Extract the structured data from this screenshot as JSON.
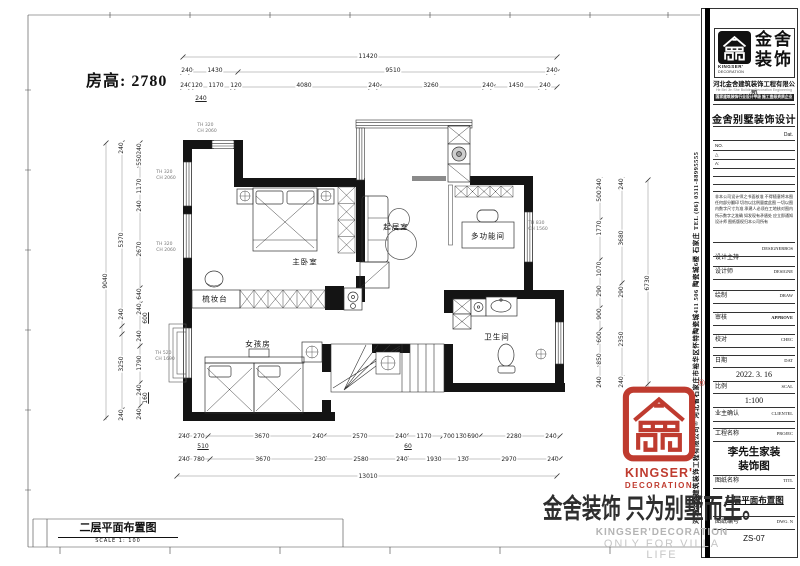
{
  "header": {
    "room_height": "房高: 2780"
  },
  "sheet": {
    "plan_label": "二层平面布置图",
    "plan_scale": "SCALE 1: 100"
  },
  "watermark": {
    "cn": "金舍装饰 只为别墅而生。",
    "en1": "KINGSER'DECORATION",
    "en2": "ONLY FOR VILLA LIFE"
  },
  "stamp": {
    "en1": "KINGSER'",
    "en2": "DECORATION",
    "reg": "®"
  },
  "colors": {
    "stamp_red": "#bf3b2f",
    "wall_black": "#141414",
    "watermark_gray": "#b4b4b4"
  },
  "tb": {
    "logo_cn1": "金舍",
    "logo_cn2": "装饰",
    "logo_en1": "KINGSER'",
    "logo_en2": "DECORATION",
    "company": "河北金舍建筑装饰工程有限公司",
    "company_en": "He Bei Jin She Building Decoration Engineering Co., L",
    "cert": "国家建筑装饰行业设计甲级 施工壹级资质企业",
    "product_title": "金舍别墅装饰设计",
    "dat_label": "Dat.",
    "no_label": "NO.",
    "tri": "△",
    "a_label": "A:",
    "note": "非本公司设计师之书面核准 不得随意将本图任何部分翻印 切勿以比例量度此图 一切以图内数字尺寸为准 承建人必须在工地核对图内所示数字之准确 如发现有矛盾处 应立即通知设计师 图纸版权归本公司所有",
    "vertical_text": "河北金舍建筑装饰工程有限公司® 河北省石家庄市裕华区怀特陶瓷城411 506 陶瓷城6楼 石家庄 TEL (86) 0311-88995555",
    "fields": [
      {
        "cn": "设计主持",
        "en": "DESIGNERBOS",
        "val": ""
      },
      {
        "cn": "设计师",
        "en": "DESIGNE",
        "val": ""
      },
      {
        "cn": "绘制",
        "en": "DRAW",
        "val": ""
      },
      {
        "cn": "审核",
        "en": "APPROVE",
        "val": ""
      },
      {
        "cn": "校对",
        "en": "CHEC",
        "val": ""
      },
      {
        "cn": "日期",
        "en": "DAT",
        "val": "2022. 3. 16"
      },
      {
        "cn": "比例",
        "en": "SCAL",
        "val": "1:100"
      },
      {
        "cn": "业主确认",
        "en": "CLIENTEL",
        "val": ""
      },
      {
        "cn": "工程名称",
        "en": "PROJEC",
        "val": "李先生家装\n装饰图"
      },
      {
        "cn": "图纸名称",
        "en": "TITL",
        "val": "二层平面布置图"
      },
      {
        "cn": "图纸编号",
        "en": "DWG. N",
        "val": "ZS-07"
      }
    ]
  },
  "plan": {
    "rooms": [
      {
        "t": "主卧室",
        "x": 305,
        "y": 262
      },
      {
        "t": "起居室",
        "x": 396,
        "y": 227
      },
      {
        "t": "多功能间",
        "x": 488,
        "y": 236
      },
      {
        "t": "梳妆台",
        "x": 215,
        "y": 299
      },
      {
        "t": "女孩房",
        "x": 258,
        "y": 344
      },
      {
        "t": "卫生间",
        "x": 497,
        "y": 337
      }
    ],
    "window_labels": [
      {
        "t": "TH 320\nCH 2060",
        "x": 207,
        "y": 129
      },
      {
        "t": "TH 320\nCH 2060",
        "x": 166,
        "y": 176
      },
      {
        "t": "TH 320\nCH 2060",
        "x": 166,
        "y": 248
      },
      {
        "t": "TH 520\nCH 1690",
        "x": 165,
        "y": 357
      },
      {
        "t": "TH 830\nCH 1560",
        "x": 538,
        "y": 227
      }
    ],
    "dims": [
      {
        "t": "11420",
        "x": 368,
        "y": 57
      },
      {
        "t": "240",
        "x": 187,
        "y": 71
      },
      {
        "t": "1430",
        "x": 215,
        "y": 71
      },
      {
        "t": "9510",
        "x": 393,
        "y": 71
      },
      {
        "t": "240",
        "x": 552,
        "y": 71
      },
      {
        "t": "240",
        "x": 186,
        "y": 86
      },
      {
        "t": "120",
        "x": 197,
        "y": 86
      },
      {
        "t": "1170",
        "x": 216,
        "y": 86
      },
      {
        "t": "120",
        "x": 236,
        "y": 86
      },
      {
        "t": "4080",
        "x": 304,
        "y": 86
      },
      {
        "t": "240",
        "x": 374,
        "y": 86
      },
      {
        "t": "3260",
        "x": 431,
        "y": 86
      },
      {
        "t": "240",
        "x": 488,
        "y": 86
      },
      {
        "t": "1450",
        "x": 516,
        "y": 86
      },
      {
        "t": "240",
        "x": 545,
        "y": 86
      },
      {
        "t": "240",
        "x": 201,
        "y": 99,
        "u": true
      },
      {
        "t": "240",
        "x": 184,
        "y": 437
      },
      {
        "t": "270",
        "x": 199,
        "y": 437
      },
      {
        "t": "3670",
        "x": 262,
        "y": 437
      },
      {
        "t": "240",
        "x": 318,
        "y": 437
      },
      {
        "t": "2570",
        "x": 360,
        "y": 437
      },
      {
        "t": "240",
        "x": 401,
        "y": 437
      },
      {
        "t": "1170",
        "x": 424,
        "y": 437
      },
      {
        "t": "700",
        "x": 449,
        "y": 437
      },
      {
        "t": "130",
        "x": 461,
        "y": 437
      },
      {
        "t": "690",
        "x": 473,
        "y": 437
      },
      {
        "t": "2280",
        "x": 514,
        "y": 437
      },
      {
        "t": "240",
        "x": 551,
        "y": 437
      },
      {
        "t": "510",
        "x": 203,
        "y": 447,
        "u": true
      },
      {
        "t": "60",
        "x": 408,
        "y": 447,
        "u": true
      },
      {
        "t": "240",
        "x": 184,
        "y": 460
      },
      {
        "t": "780",
        "x": 199,
        "y": 460
      },
      {
        "t": "3670",
        "x": 263,
        "y": 460
      },
      {
        "t": "230",
        "x": 320,
        "y": 460
      },
      {
        "t": "2580",
        "x": 361,
        "y": 460
      },
      {
        "t": "240",
        "x": 402,
        "y": 460
      },
      {
        "t": "1930",
        "x": 434,
        "y": 460
      },
      {
        "t": "130",
        "x": 463,
        "y": 460
      },
      {
        "t": "2970",
        "x": 509,
        "y": 460
      },
      {
        "t": "240",
        "x": 553,
        "y": 460
      },
      {
        "t": "13010",
        "x": 368,
        "y": 477
      },
      {
        "t": "240",
        "x": 140,
        "y": 149,
        "r": 1
      },
      {
        "t": "550",
        "x": 140,
        "y": 160,
        "r": 1
      },
      {
        "t": "1170",
        "x": 140,
        "y": 186,
        "r": 1
      },
      {
        "t": "240",
        "x": 140,
        "y": 206,
        "r": 1
      },
      {
        "t": "2670",
        "x": 140,
        "y": 249,
        "r": 1
      },
      {
        "t": "640",
        "x": 140,
        "y": 294,
        "r": 1
      },
      {
        "t": "240",
        "x": 140,
        "y": 309,
        "r": 1
      },
      {
        "t": "600",
        "x": 146,
        "y": 318,
        "r": 1,
        "u": true
      },
      {
        "t": "240",
        "x": 140,
        "y": 336,
        "r": 1
      },
      {
        "t": "1790",
        "x": 140,
        "y": 363,
        "r": 1
      },
      {
        "t": "240",
        "x": 140,
        "y": 390,
        "r": 1
      },
      {
        "t": "160",
        "x": 146,
        "y": 398,
        "r": 1,
        "u": true
      },
      {
        "t": "240",
        "x": 140,
        "y": 414,
        "r": 1
      },
      {
        "t": "240",
        "x": 122,
        "y": 148,
        "r": 1
      },
      {
        "t": "5370",
        "x": 122,
        "y": 240,
        "r": 1
      },
      {
        "t": "240",
        "x": 122,
        "y": 314,
        "r": 1
      },
      {
        "t": "3250",
        "x": 122,
        "y": 364,
        "r": 1
      },
      {
        "t": "240",
        "x": 122,
        "y": 415,
        "r": 1
      },
      {
        "t": "9040",
        "x": 106,
        "y": 281,
        "r": 1
      },
      {
        "t": "240",
        "x": 600,
        "y": 184,
        "r": 1
      },
      {
        "t": "500",
        "x": 600,
        "y": 196,
        "r": 1
      },
      {
        "t": "1770",
        "x": 600,
        "y": 228,
        "r": 1
      },
      {
        "t": "1070",
        "x": 600,
        "y": 269,
        "r": 1
      },
      {
        "t": "290",
        "x": 600,
        "y": 291,
        "r": 1
      },
      {
        "t": "900",
        "x": 600,
        "y": 314,
        "r": 1
      },
      {
        "t": "600",
        "x": 600,
        "y": 337,
        "r": 1
      },
      {
        "t": "850",
        "x": 600,
        "y": 359,
        "r": 1
      },
      {
        "t": "240",
        "x": 600,
        "y": 382,
        "r": 1
      },
      {
        "t": "240",
        "x": 622,
        "y": 184,
        "r": 1
      },
      {
        "t": "3680",
        "x": 622,
        "y": 238,
        "r": 1
      },
      {
        "t": "290",
        "x": 622,
        "y": 292,
        "r": 1
      },
      {
        "t": "2350",
        "x": 622,
        "y": 339,
        "r": 1
      },
      {
        "t": "240",
        "x": 622,
        "y": 382,
        "r": 1
      },
      {
        "t": "6730",
        "x": 648,
        "y": 283,
        "r": 1
      }
    ]
  }
}
